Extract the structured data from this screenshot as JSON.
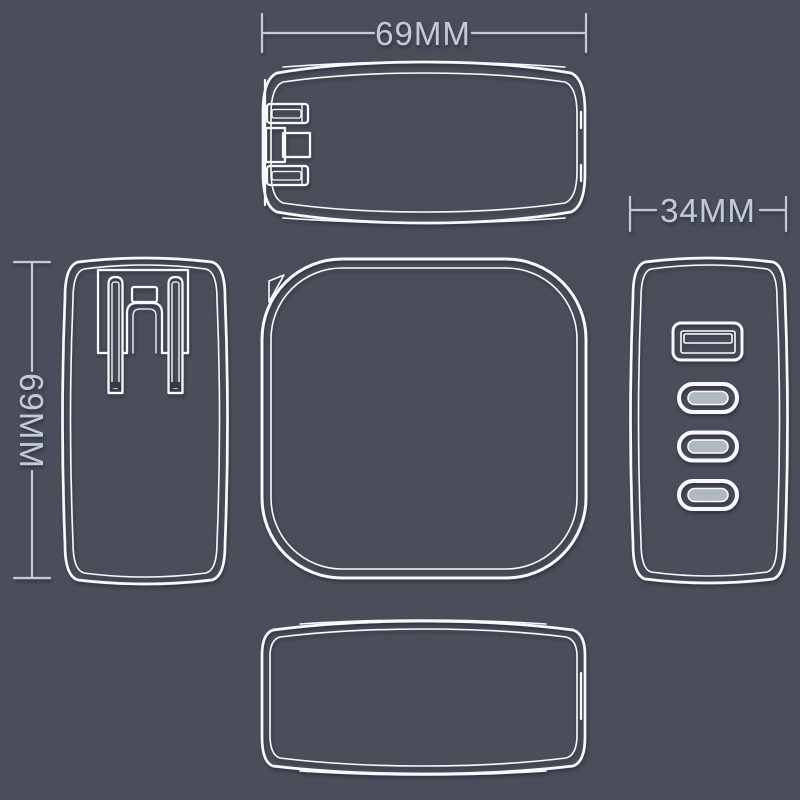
{
  "colors": {
    "background": "#4a4e5a",
    "line": "#f7f8fa",
    "dimension": "#c3cad7",
    "groove": "#343946",
    "usb_tongue": "#b9bfc9"
  },
  "dimensions": {
    "top_width_label": "69MM",
    "left_height_label": "69MM",
    "right_width_label": "34MM"
  },
  "views": {
    "top": "top-view-folded-prongs",
    "left": "side-view-prongs-extended",
    "front": "front-view",
    "right": "port-side-view",
    "bottom": "bottom-view",
    "ports": [
      "usb-a-port",
      "usb-c-port",
      "usb-c-port",
      "usb-c-port"
    ]
  }
}
